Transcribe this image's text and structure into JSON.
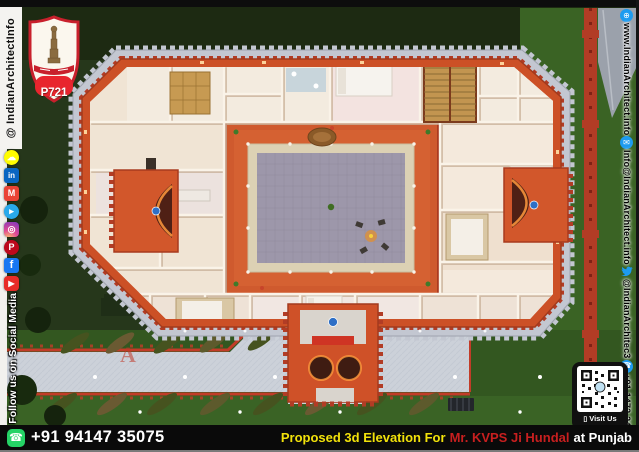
{
  "poster": {
    "logo_badge": {
      "code": "P721"
    },
    "left_bar": {
      "handle": "@ IndianArchitectInfo",
      "follow_text": "Follow us on Social Media",
      "icons": [
        {
          "name": "snapchat-icon",
          "glyph": "☁"
        },
        {
          "name": "linkedin-icon",
          "glyph": "in"
        },
        {
          "name": "gmail-icon",
          "glyph": "M"
        },
        {
          "name": "telegram-icon",
          "glyph": "▸"
        },
        {
          "name": "instagram-icon",
          "glyph": "◎"
        },
        {
          "name": "pinterest-icon",
          "glyph": "P"
        },
        {
          "name": "facebook-icon",
          "glyph": "f"
        },
        {
          "name": "youtube-icon",
          "glyph": "▶"
        }
      ]
    },
    "right_bar": {
      "website": "www.IndianArchitect.info",
      "email": "Info@IndianArchitect.info",
      "twitter_handle": "@IndianArchitec3",
      "phone": "+91 1472 244802",
      "icons": {
        "globe": "⊕",
        "email": "✉",
        "phone": "☎"
      },
      "icon_names": [
        "globe-icon",
        "email-icon",
        "twitter-icon",
        "phone-icon"
      ]
    },
    "qr_block": {
      "label": "Visit Us",
      "phone_glyph": "▯"
    },
    "bottom_bar": {
      "whatsapp_glyph": "☎",
      "phone": "+91 94147 35075",
      "title_prefix": "Proposed 3d Elevation For",
      "client_name": "Mr. KVPS Ji Hundal",
      "location": "at Punjab"
    },
    "watermark": {
      "letter": "A",
      "text": "Architect"
    },
    "colors": {
      "accent_orange": "#cf5128",
      "wall_red": "#b03324",
      "grass_dark": "#24331a",
      "grass_light": "#3a6322",
      "courtyard_grey": "#9d97aa",
      "title_yellow": "#f2e20a",
      "client_red": "#c81f1f",
      "whatsapp_green": "#25d366",
      "social_blue": "#1d9bf0"
    }
  }
}
